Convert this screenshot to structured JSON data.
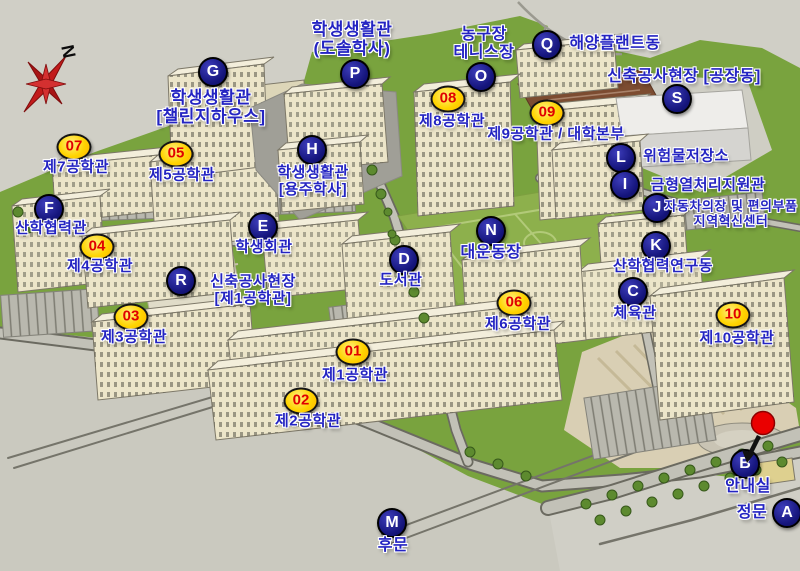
{
  "compass": {
    "north_label": "N"
  },
  "colors": {
    "letter_marker_bg": "#15157c",
    "letter_marker_text": "#ffffff",
    "number_badge_bg": "#ffd400",
    "number_badge_text": "#e00000",
    "label_text": "#2424c2",
    "current_position_dot": "#ea0000",
    "campus_green": "#79a33e",
    "terrain_gray": "#d0cfc6"
  },
  "current_position": {
    "x": 763,
    "y": 423
  },
  "locations": [
    {
      "id": "dorm-challenge-house",
      "marker_type": "letter",
      "marker_text": "G",
      "marker_x": 213,
      "marker_y": 72,
      "label_x": 211,
      "label_y": 107,
      "font_size": 17,
      "lines": [
        "학생생활관",
        "[챌린지하우스]"
      ]
    },
    {
      "id": "dorm-dosol",
      "marker_type": "letter",
      "marker_text": "P",
      "marker_x": 355,
      "marker_y": 74,
      "label_x": 352,
      "label_y": 39,
      "font_size": 17,
      "lines": [
        "학생생활관",
        "(도솔학사)"
      ]
    },
    {
      "id": "basketball-tennis-courts",
      "marker_type": "letter",
      "marker_text": "O",
      "marker_x": 481,
      "marker_y": 77,
      "label_x": 484,
      "label_y": 44,
      "font_size": 16,
      "lines": [
        "농구장",
        "테니스장"
      ]
    },
    {
      "id": "marine-plant-bldg",
      "marker_type": "letter",
      "marker_text": "Q",
      "marker_x": 547,
      "marker_y": 45,
      "label_x": 615,
      "label_y": 44,
      "font_size": 16,
      "lines": [
        "해양플랜트동"
      ]
    },
    {
      "id": "construction-site-factory",
      "marker_type": "letter",
      "marker_text": "S",
      "marker_x": 677,
      "marker_y": 99,
      "label_x": 684,
      "label_y": 77,
      "font_size": 16,
      "lines": [
        "신축공사현장 [공장동]"
      ]
    },
    {
      "id": "eng-bldg-8",
      "marker_type": "number",
      "marker_text": "08",
      "marker_x": 448,
      "marker_y": 99,
      "label_x": 452,
      "label_y": 122,
      "font_size": 15,
      "lines": [
        "제8공학관"
      ]
    },
    {
      "id": "eng-bldg-9-univ-hq",
      "marker_type": "number",
      "marker_text": "09",
      "marker_x": 547,
      "marker_y": 113,
      "label_x": 556,
      "label_y": 135,
      "font_size": 15,
      "lines": [
        "제9공학관 / 대학본부"
      ]
    },
    {
      "id": "hazmat-storage",
      "marker_type": "letter",
      "marker_text": "L",
      "marker_x": 621,
      "marker_y": 158,
      "label_x": 686,
      "label_y": 157,
      "font_size": 15,
      "lines": [
        "위험물저장소"
      ]
    },
    {
      "id": "mold-heat-treatment-center",
      "marker_type": "letter",
      "marker_text": "I",
      "marker_x": 625,
      "marker_y": 185,
      "label_x": 708,
      "label_y": 186,
      "font_size": 15,
      "lines": [
        "금형열처리지원관"
      ]
    },
    {
      "id": "auto-parts-regional-innovation-center",
      "marker_type": "letter",
      "marker_text": "J",
      "marker_x": 657,
      "marker_y": 208,
      "label_x": 731,
      "label_y": 214,
      "font_size": 13,
      "lines": [
        "자동차의장 및 편의부품",
        "지역혁신센터"
      ]
    },
    {
      "id": "industry-coop-research-bldg",
      "marker_type": "letter",
      "marker_text": "K",
      "marker_x": 656,
      "marker_y": 246,
      "label_x": 663,
      "label_y": 267,
      "font_size": 15,
      "lines": [
        "산학협력연구동"
      ]
    },
    {
      "id": "gymnasium",
      "marker_type": "letter",
      "marker_text": "C",
      "marker_x": 633,
      "marker_y": 292,
      "label_x": 635,
      "label_y": 314,
      "font_size": 15,
      "lines": [
        "체육관"
      ]
    },
    {
      "id": "eng-bldg-10",
      "marker_type": "number",
      "marker_text": "10",
      "marker_x": 733,
      "marker_y": 315,
      "label_x": 737,
      "label_y": 339,
      "font_size": 15,
      "lines": [
        "제10공학관"
      ]
    },
    {
      "id": "main-athletic-field",
      "marker_type": "letter",
      "marker_text": "N",
      "marker_x": 491,
      "marker_y": 231,
      "label_x": 491,
      "label_y": 253,
      "font_size": 16,
      "lines": [
        "대운동장"
      ]
    },
    {
      "id": "library",
      "marker_type": "letter",
      "marker_text": "D",
      "marker_x": 404,
      "marker_y": 260,
      "label_x": 401,
      "label_y": 281,
      "font_size": 15,
      "lines": [
        "도서관"
      ]
    },
    {
      "id": "eng-bldg-6",
      "marker_type": "number",
      "marker_text": "06",
      "marker_x": 514,
      "marker_y": 303,
      "label_x": 518,
      "label_y": 325,
      "font_size": 15,
      "lines": [
        "제6공학관"
      ]
    },
    {
      "id": "student-union",
      "marker_type": "letter",
      "marker_text": "E",
      "marker_x": 263,
      "marker_y": 227,
      "label_x": 264,
      "label_y": 248,
      "font_size": 15,
      "lines": [
        "학생회관"
      ]
    },
    {
      "id": "dorm-yongju",
      "marker_type": "letter",
      "marker_text": "H",
      "marker_x": 312,
      "marker_y": 150,
      "label_x": 313,
      "label_y": 182,
      "font_size": 15,
      "lines": [
        "학생생활관",
        "[용주학사]"
      ]
    },
    {
      "id": "eng-bldg-7",
      "marker_type": "number",
      "marker_text": "07",
      "marker_x": 74,
      "marker_y": 147,
      "label_x": 76,
      "label_y": 168,
      "font_size": 15,
      "lines": [
        "제7공학관"
      ]
    },
    {
      "id": "eng-bldg-5",
      "marker_type": "number",
      "marker_text": "05",
      "marker_x": 176,
      "marker_y": 154,
      "label_x": 182,
      "label_y": 176,
      "font_size": 15,
      "lines": [
        "제5공학관"
      ]
    },
    {
      "id": "industry-coop-bldg",
      "marker_type": "letter",
      "marker_text": "F",
      "marker_x": 49,
      "marker_y": 209,
      "label_x": 51,
      "label_y": 229,
      "font_size": 15,
      "lines": [
        "산학협력관"
      ]
    },
    {
      "id": "eng-bldg-4",
      "marker_type": "number",
      "marker_text": "04",
      "marker_x": 97,
      "marker_y": 247,
      "label_x": 100,
      "label_y": 267,
      "font_size": 15,
      "lines": [
        "제4공학관"
      ]
    },
    {
      "id": "construction-site-eng1",
      "marker_type": "letter",
      "marker_text": "R",
      "marker_x": 181,
      "marker_y": 281,
      "label_x": 253,
      "label_y": 291,
      "font_size": 15,
      "lines": [
        "신축공사현장",
        "[제1공학관]"
      ]
    },
    {
      "id": "eng-bldg-3",
      "marker_type": "number",
      "marker_text": "03",
      "marker_x": 131,
      "marker_y": 317,
      "label_x": 134,
      "label_y": 338,
      "font_size": 15,
      "lines": [
        "제3공학관"
      ]
    },
    {
      "id": "eng-bldg-1",
      "marker_type": "number",
      "marker_text": "01",
      "marker_x": 353,
      "marker_y": 352,
      "label_x": 355,
      "label_y": 376,
      "font_size": 15,
      "lines": [
        "제1공학관"
      ]
    },
    {
      "id": "eng-bldg-2",
      "marker_type": "number",
      "marker_text": "02",
      "marker_x": 301,
      "marker_y": 401,
      "label_x": 308,
      "label_y": 422,
      "font_size": 15,
      "lines": [
        "제2공학관"
      ]
    },
    {
      "id": "back-gate",
      "marker_type": "letter",
      "marker_text": "M",
      "marker_x": 392,
      "marker_y": 523,
      "label_x": 393,
      "label_y": 546,
      "font_size": 16,
      "lines": [
        "후문"
      ]
    },
    {
      "id": "info-booth",
      "marker_type": "letter",
      "marker_text": "B",
      "marker_x": 745,
      "marker_y": 464,
      "label_x": 748,
      "label_y": 487,
      "font_size": 16,
      "lines": [
        "안내실"
      ]
    },
    {
      "id": "main-gate",
      "marker_type": "letter",
      "marker_text": "A",
      "marker_x": 787,
      "marker_y": 513,
      "label_x": 752,
      "label_y": 513,
      "font_size": 16,
      "lines": [
        "정문"
      ]
    }
  ]
}
